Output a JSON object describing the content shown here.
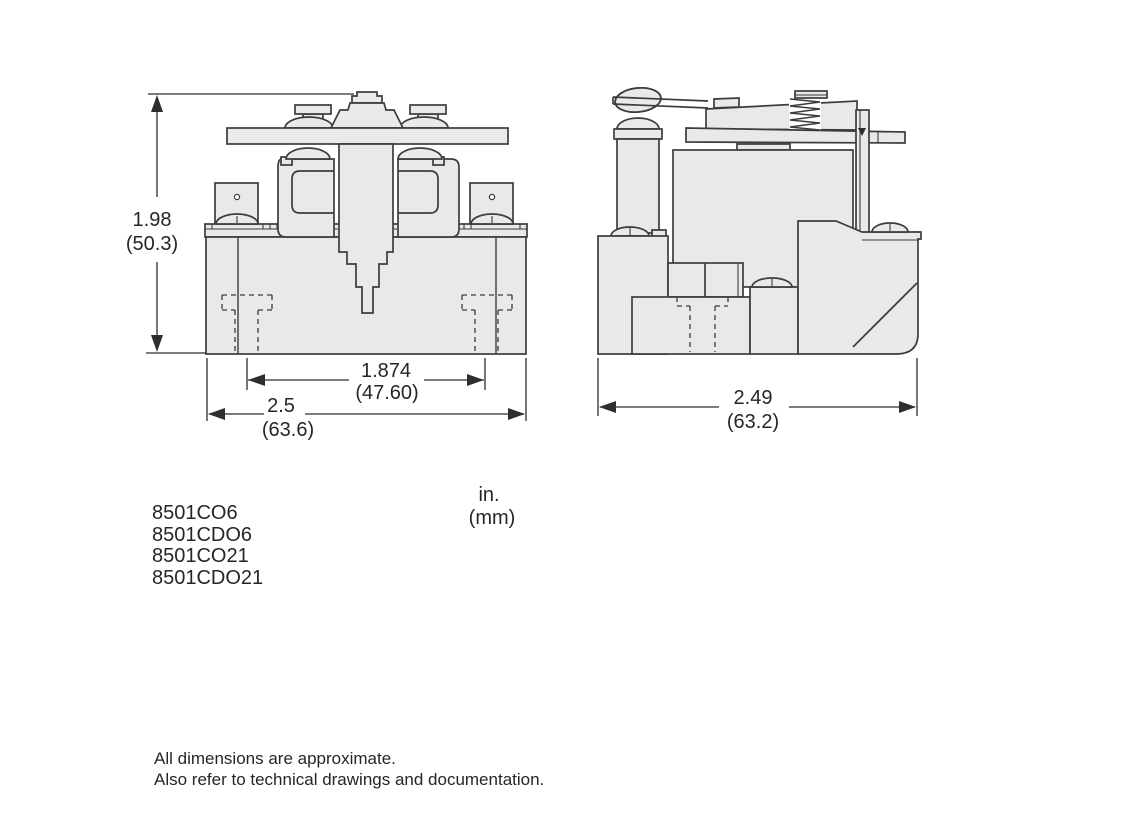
{
  "figure": {
    "type": "technical-dimension-drawing",
    "subject": "relay outline drawing, front and side views",
    "views": {
      "front": {
        "height_dim": {
          "in": "1.98",
          "mm": "(50.3)"
        },
        "slot_spacing_dim": {
          "in": "1.874",
          "mm": "(47.60)"
        },
        "width_dim": {
          "in": "2.5",
          "mm": "(63.6)"
        }
      },
      "side": {
        "depth_dim": {
          "in": "2.49",
          "mm": "(63.2)"
        }
      }
    },
    "units_note": {
      "line1": "in.",
      "line2": "(mm)"
    },
    "models": [
      "8501CO6",
      "8501CDO6",
      "8501CO21",
      "8501CDO21"
    ],
    "footnotes": [
      "All dimensions are approximate.",
      "Also refer to technical drawings and documentation."
    ],
    "colors": {
      "background": "#ffffff",
      "part_fill": "#e9e9e9",
      "line": "#3c3c3c",
      "dim_line": "#2e2e2e",
      "text": "#262626"
    }
  }
}
